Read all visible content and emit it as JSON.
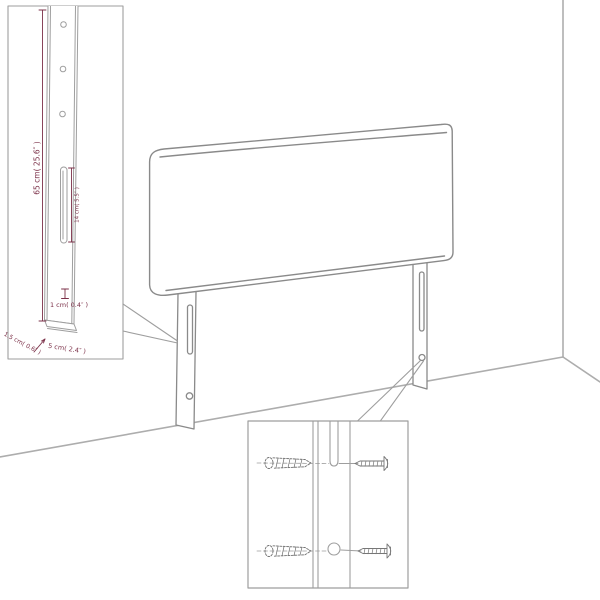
{
  "diagram": {
    "type": "product-assembly-dimension-diagram",
    "subject": "upholstered headboard with two mounting legs, shown against a room corner",
    "colors": {
      "line": "#9e9e9e",
      "line_dark": "#8a8a8a",
      "wall": "#adadad",
      "dimension": "#7b3048",
      "background": "#ffffff"
    },
    "callout_leg": {
      "height_label": "65 cm( 25.6″ )",
      "slot_label": "14 cm( 5.5″ )",
      "hole_label": "1 cm( 0.4″ )",
      "thickness_label": "1.5 cm( 0.6″ )",
      "width_label": "5 cm( 2.4″ )"
    },
    "callout_screws": {
      "description": "close-up of leg slot and hole with wall screws"
    }
  }
}
